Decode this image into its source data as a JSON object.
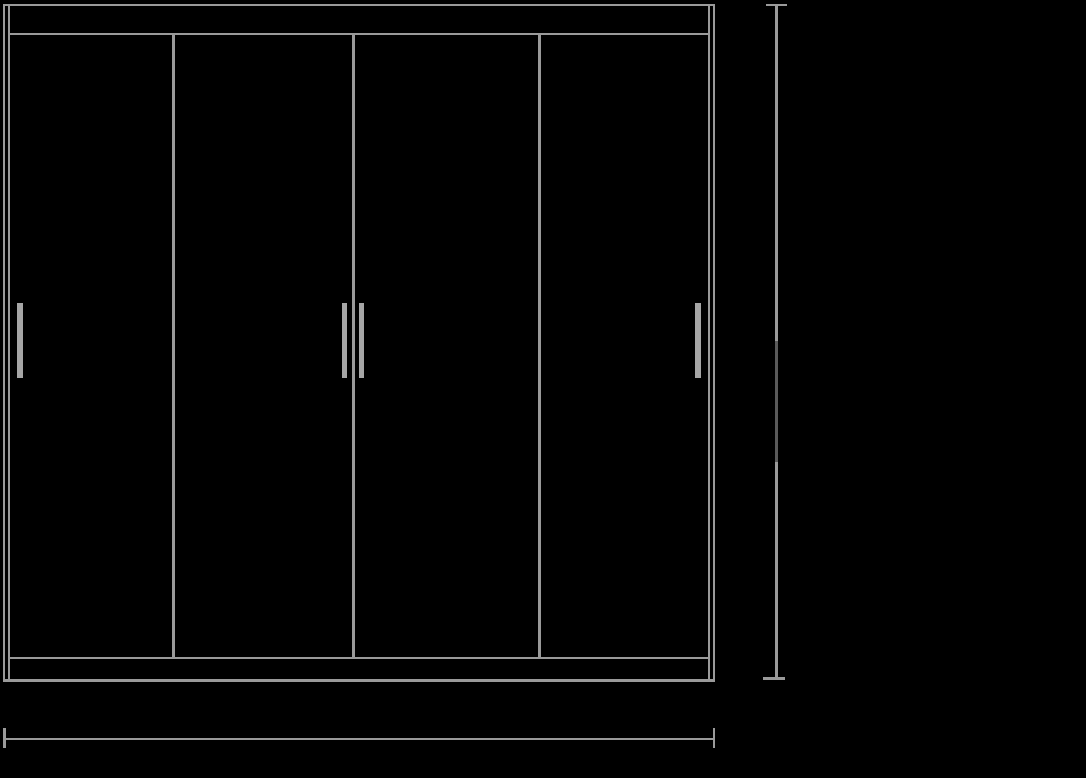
{
  "page": {
    "background_color": "#000000"
  },
  "drawing": {
    "name": "sliding-door wardrobe front elevation line drawing",
    "style": {
      "line_color": "#9a9a9a",
      "handle_color": "#a6a6a6",
      "dim_line_dark_segment_color": "#5a5a5a",
      "background_color": "#000000"
    },
    "wardrobe": {
      "door_count": 4,
      "divider_count": 3,
      "handle_count": 4,
      "doors": [
        {
          "id": "door-panel-1",
          "handle_position": "left-edge"
        },
        {
          "id": "door-panel-2",
          "handle_position": "right-edge"
        },
        {
          "id": "door-panel-3",
          "handle_position": "left-edge"
        },
        {
          "id": "door-panel-4",
          "handle_position": "right-edge"
        }
      ]
    },
    "dimension_annotations": {
      "vertical_height_line": {
        "position": "right-of-wardrobe",
        "has_end_caps": true,
        "visible_label": ""
      },
      "horizontal_width_line": {
        "position": "below-wardrobe",
        "has_end_caps": true,
        "visible_label": ""
      }
    }
  }
}
